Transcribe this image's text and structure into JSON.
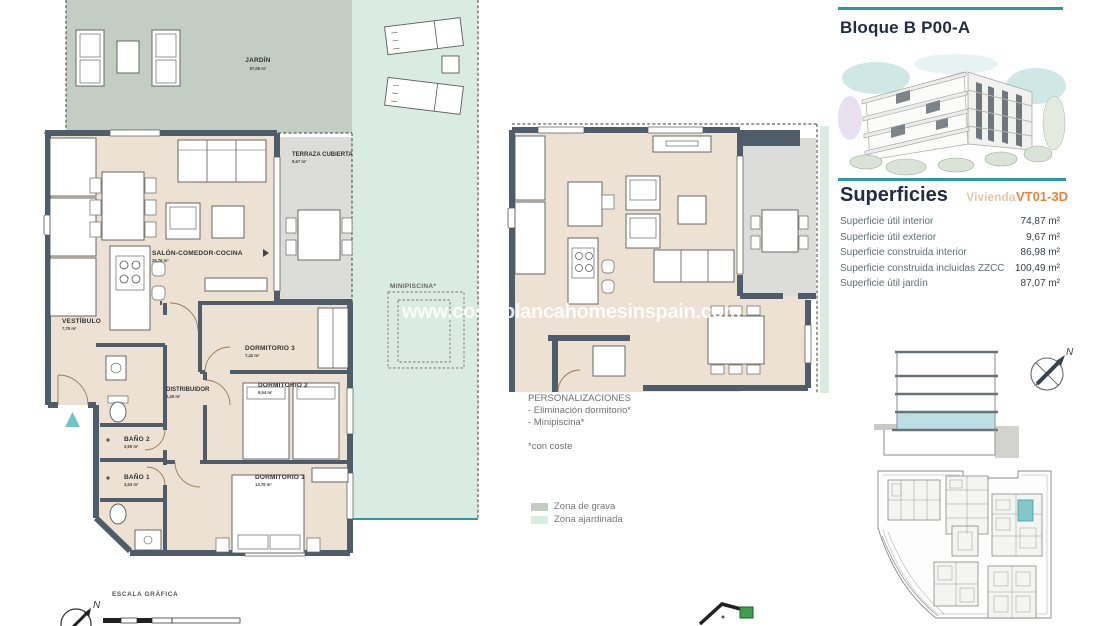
{
  "watermark": "www.costablancahomesinspain.com",
  "plan": {
    "rooms": {
      "jardin": {
        "name": "JARDÍN",
        "area": "87,06 m²"
      },
      "terraza": {
        "name": "TERRAZA CUBIERTA",
        "area": "9,67 m²"
      },
      "salon": {
        "name": "SALÓN-COMEDOR-COCINA",
        "area": "26,76 m²"
      },
      "vestibulo": {
        "name": "VESTÍBULO",
        "area": "7,75 m²"
      },
      "dormitorio3": {
        "name": "DORMITORIO 3",
        "area": "7,42 m²"
      },
      "dormitorio2": {
        "name": "DORMITORIO 2",
        "area": "9,54 m²"
      },
      "distribuidor": {
        "name": "DISTRIBUIDOR",
        "area": "2,49 m²"
      },
      "bano2": {
        "name": "BAÑO 2",
        "area": "3,50 m²"
      },
      "bano1": {
        "name": "BAÑO 1",
        "area": "3,63 m²"
      },
      "dormitorio1": {
        "name": "DORMITORIO 1",
        "area": "13,78 m²"
      },
      "minipiscina": {
        "name": "MINIPISCINA*"
      }
    }
  },
  "personalizaciones": {
    "title": "PERSONALIZACIONES",
    "item1": "- Eliminación dormitorio*",
    "item2": "- Minipiscina*",
    "note": "*con coste"
  },
  "legend": {
    "grava": "Zona de grava",
    "ajardinada": "Zona ajardinada"
  },
  "scale_label": "ESCALA GRÁFICA",
  "compass_label": "N",
  "sidebar": {
    "block_title": "Bloque B P00-A",
    "surfaces_title": "Superficies",
    "surfaces_subtitle": "Vivienda",
    "unit_code": "VT01-3D",
    "rows": [
      {
        "label": "Superficie útil interior",
        "value": "74,87 m²"
      },
      {
        "label": "Superficie útil exterior",
        "value": "9,67 m²"
      },
      {
        "label": "Superficie construida interior",
        "value": "86,98 m²"
      },
      {
        "label": "Superficie construida incluidas ZZCC",
        "value": "100,49 m²"
      },
      {
        "label": "Superficie útil jardín",
        "value": "87,07 m²"
      }
    ]
  },
  "colors": {
    "accent_teal": "#2a9aa0",
    "navy": "#222c45",
    "orange": "#e8823e",
    "tan": "#e7c5a8",
    "wall": "#4e5d69",
    "floor_beige": "#ece1d2",
    "terrace_gray": "#dcdcda",
    "zona_grava": "#c3cdc3",
    "zona_ajardinada": "#d9ebe2",
    "section_highlight": "#bcdfe5",
    "entrance_marker": "#6ec6c6"
  }
}
